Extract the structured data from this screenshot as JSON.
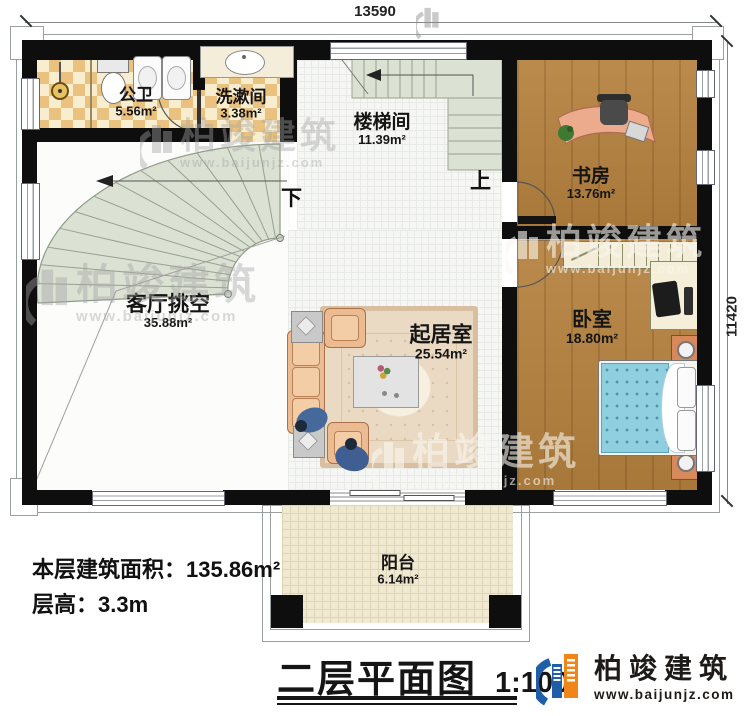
{
  "title": {
    "name": "二层平面图",
    "scale": "1:100"
  },
  "brand": {
    "name": "柏竣建筑",
    "website": "www.baijunjz.com"
  },
  "footer": {
    "area_text": "本层建筑面积：135.86m²",
    "floor_height_text": "层高：3.3m"
  },
  "dimensions": {
    "width_mm": "13590",
    "depth_mm": "11420"
  },
  "stairs": {
    "down_label": "下",
    "up_label": "上"
  },
  "rooms": {
    "public_bath": {
      "label": "公卫",
      "area": "5.56m²"
    },
    "washroom": {
      "label": "洗漱间",
      "area": "3.38m²"
    },
    "stairwell": {
      "label": "楼梯间",
      "area": "11.39m²"
    },
    "study": {
      "label": "书房",
      "area": "13.76m²"
    },
    "living_void": {
      "label": "客厅挑空",
      "area": "35.88m²"
    },
    "family_room": {
      "label": "起居室",
      "area": "25.54m²"
    },
    "bedroom": {
      "label": "卧室",
      "area": "18.80m²"
    },
    "balcony": {
      "label": "阳台",
      "area": "6.14m²"
    }
  },
  "colors": {
    "wall": "#0e0e0e",
    "wood_floor": "#b5823f",
    "tile_checker": "#eac17e",
    "stair_tread": "#dbe1d3",
    "bed_blue": "#8fcfe0",
    "sofa_peach": "#edbb92",
    "logo_blue": "#1e5fa8",
    "logo_orange": "#f08519"
  }
}
